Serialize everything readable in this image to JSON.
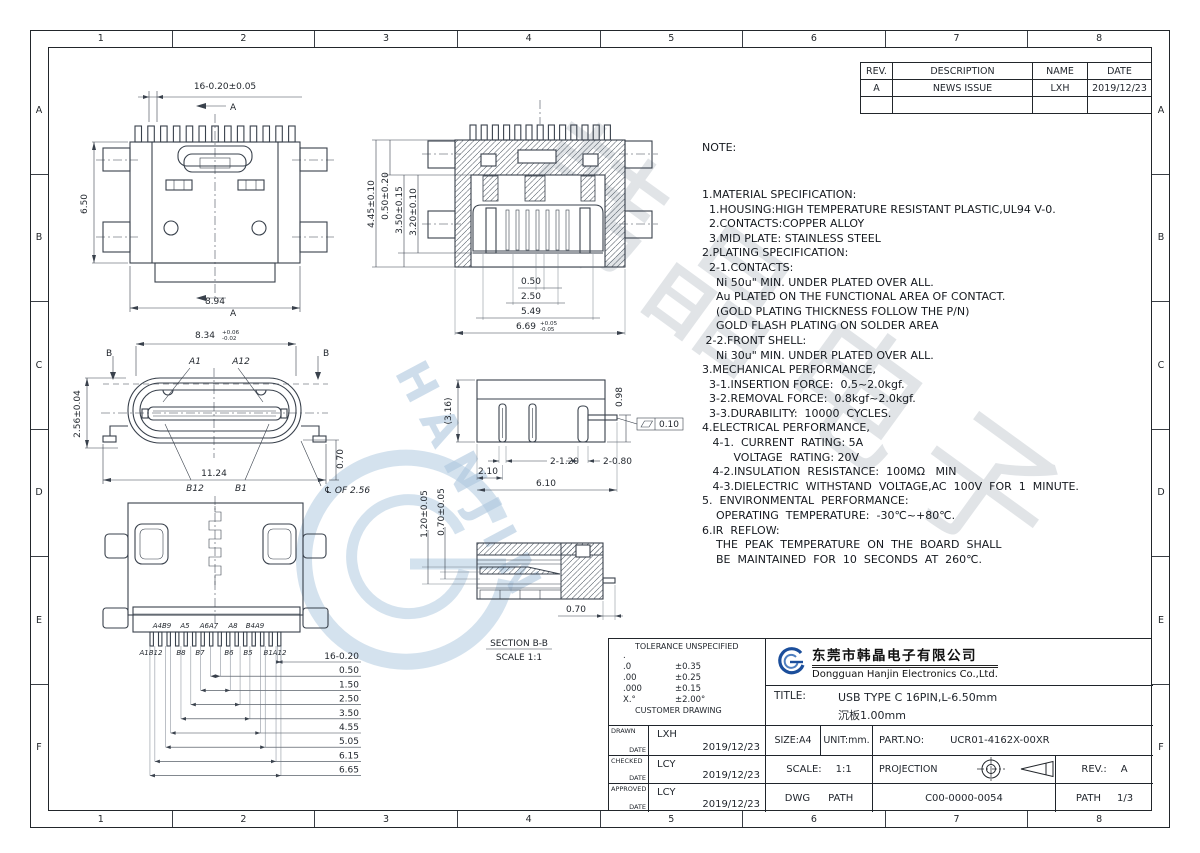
{
  "page": {
    "columns": [
      "1",
      "2",
      "3",
      "4",
      "5",
      "6",
      "7",
      "8"
    ],
    "rows": [
      "A",
      "B",
      "C",
      "D",
      "E",
      "F"
    ]
  },
  "revision_table": {
    "headers": [
      "REV.",
      "DESCRIPTION",
      "NAME",
      "DATE"
    ],
    "row": [
      "A",
      "NEWS ISSUE",
      "LXH",
      "2019/12/23"
    ]
  },
  "notes": {
    "title": "NOTE:",
    "lines": [
      "1.MATERIAL SPECIFICATION:",
      "  1.HOUSING:HIGH TEMPERATURE RESISTANT PLASTIC,UL94 V-0.",
      "  2.CONTACTS:COPPER ALLOY",
      "  3.MID PLATE: STAINLESS STEEL",
      "2.PLATING SPECIFICATION:",
      "  2-1.CONTACTS:",
      "    Ni 50u\" MIN. UNDER PLATED OVER ALL.",
      "    Au PLATED ON THE FUNCTIONAL AREA OF CONTACT.",
      "    (GOLD PLATING THICKNESS FOLLOW THE P/N)",
      "    GOLD FLASH PLATING ON SOLDER AREA",
      " 2-2.FRONT SHELL:",
      "    Ni 30u\" MIN. UNDER PLATED OVER ALL.",
      "3.MECHANICAL PERFORMANCE,",
      "  3-1.INSERTION FORCE:  0.5~2.0kgf.",
      "  3-2.REMOVAL FORCE:  0.8kgf~2.0kgf.",
      "  3-3.DURABILITY:  10000  CYCLES.",
      "4.ELECTRICAL PERFORMANCE,",
      "   4-1.  CURRENT  RATING: 5A",
      "         VOLTAGE  RATING: 20V",
      "   4-2.INSULATION  RESISTANCE:  100MΩ   MIN",
      "   4-3.DIELECTRIC  WITHSTAND  VOLTAGE,AC  100V  FOR  1  MINUTE.",
      "5.  ENVIRONMENTAL  PERFORMANCE:",
      "    OPERATING  TEMPERATURE:  -30℃~+80℃.",
      "6.IR  REFLOW:",
      "    THE  PEAK  TEMPERATURE  ON  THE  BOARD  SHALL",
      "    BE  MAINTAINED  FOR  10  SECONDS  AT  260℃."
    ]
  },
  "views": {
    "top": {
      "dim_pitch": "16-0.20±0.05",
      "dim_height": "6.50",
      "dim_width": "8.94",
      "section": "A"
    },
    "front": {
      "dim_v1": "4.45±0.10",
      "dim_v2": "0.50±0.20",
      "dim_v3": "3.50±0.15",
      "dim_v4": "3.20±0.10",
      "dim_b1": "0.50",
      "dim_b2": "2.50",
      "dim_b3": "5.49",
      "dim_b4": "6.69",
      "dim_b4_up": "+0.05",
      "dim_b4_dn": "-0.05"
    },
    "face": {
      "dim_top": "8.34",
      "tol_up": "+0.06",
      "tol_dn": "-0.02",
      "a1": "A1",
      "a12": "A12",
      "b12": "B12",
      "b1": "B1",
      "b": "B",
      "dim_left": "2.56±0.04",
      "dim_bottom": "11.24",
      "dim_right": "0.70",
      "cl_note": "℄ OF 2.56"
    },
    "side": {
      "dim_left": "(3.16)",
      "dim_right": "0.98",
      "flat": "0.10",
      "d1": "2-1.20",
      "d2": "2-0.80",
      "d3": "2.10",
      "d4": "6.10"
    },
    "bottom": {
      "pins_top": [
        "A4B9",
        "A5",
        "A6A7",
        "A8",
        "B4A9"
      ],
      "pins_bottom": [
        "A1B12",
        "B8",
        "B7",
        "B6",
        "B5",
        "B1A12"
      ],
      "ladder": [
        "16-0.20",
        "0.50",
        "1.50",
        "2.50",
        "3.50",
        "4.55",
        "5.05",
        "6.15",
        "6.65"
      ]
    },
    "section_bb": {
      "dim_v1": "1.20±0.05",
      "dim_v2": "0.70±0.05",
      "dim_b": "0.70",
      "caption": "SECTION B-B",
      "scale": "SCALE 1:1"
    }
  },
  "tolerance": {
    "title": "TOLERANCE UNSPECIFIED",
    "dot": ".",
    "rows": [
      [
        ".0",
        "±0.35"
      ],
      [
        ".00",
        "±0.25"
      ],
      [
        ".000",
        "±0.15"
      ],
      [
        "X.°",
        "±2.00°"
      ]
    ],
    "footer": "CUSTOMER DRAWING"
  },
  "company": {
    "cn": "东莞市韩晶电子有限公司",
    "en": "Dongguan Hanjin Electronics Co.,Ltd."
  },
  "title_block": {
    "title_label": "TITLE:",
    "title_line1": "USB TYPE C 16PIN,L-6.50mm",
    "title_line2": "沉板1.00mm",
    "drawn_label": "DRAWN",
    "checked_label": "CHECKED",
    "approved_label": "APPROVED",
    "date_label": "DATE",
    "drawn_name": "LXH",
    "drawn_date": "2019/12/23",
    "checked_name": "LCY",
    "checked_date": "2019/12/23",
    "approved_name": "LCY",
    "approved_date": "2019/12/23",
    "size": "SIZE:A4",
    "unit": "UNIT:mm.",
    "part_label": "PART.NO:",
    "part_no": "UCR01-4162X-00XR",
    "scale_label": "SCALE:",
    "scale": "1:1",
    "projection_label": "PROJECTION",
    "rev_label": "REV.:",
    "rev": "A",
    "dwg_label": "DWG",
    "dwg_path_label": "PATH",
    "dwg_no": "C00-0000-0054",
    "sheet_label": "PATH",
    "sheet": "1/3"
  },
  "watermark": {
    "cn": "韩晶电子",
    "en": "HANJIN"
  }
}
